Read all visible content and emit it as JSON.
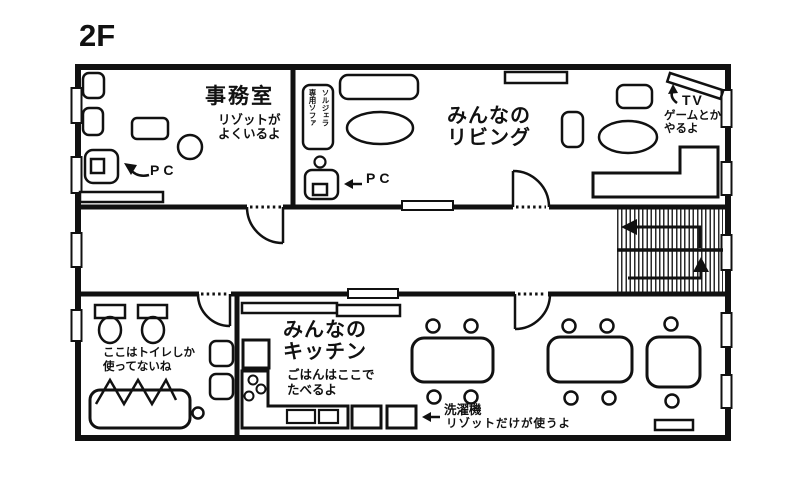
{
  "floor": {
    "title": "2F"
  },
  "rooms": {
    "office": {
      "name": "事務室",
      "note": "リゾットが\nよくいるよ",
      "pc_label": "PC"
    },
    "living": {
      "name": "みんなの\nリビング",
      "pc_label": "PC",
      "tv_label": "TV",
      "tv_note": "ゲームとか\nやるよ",
      "sofa_tag": "ソルジェラ\n専用ソファ"
    },
    "bathroom": {
      "note": "ここはトイレしか\n使ってないね"
    },
    "kitchen": {
      "name": "みんなの\nキッチン",
      "note": "ごはんはここで\nたべるよ",
      "washer_label": "洗濯機",
      "washer_note": "リゾットだけが使うよ"
    }
  },
  "colors": {
    "ink": "#111111",
    "background": "#ffffff"
  }
}
